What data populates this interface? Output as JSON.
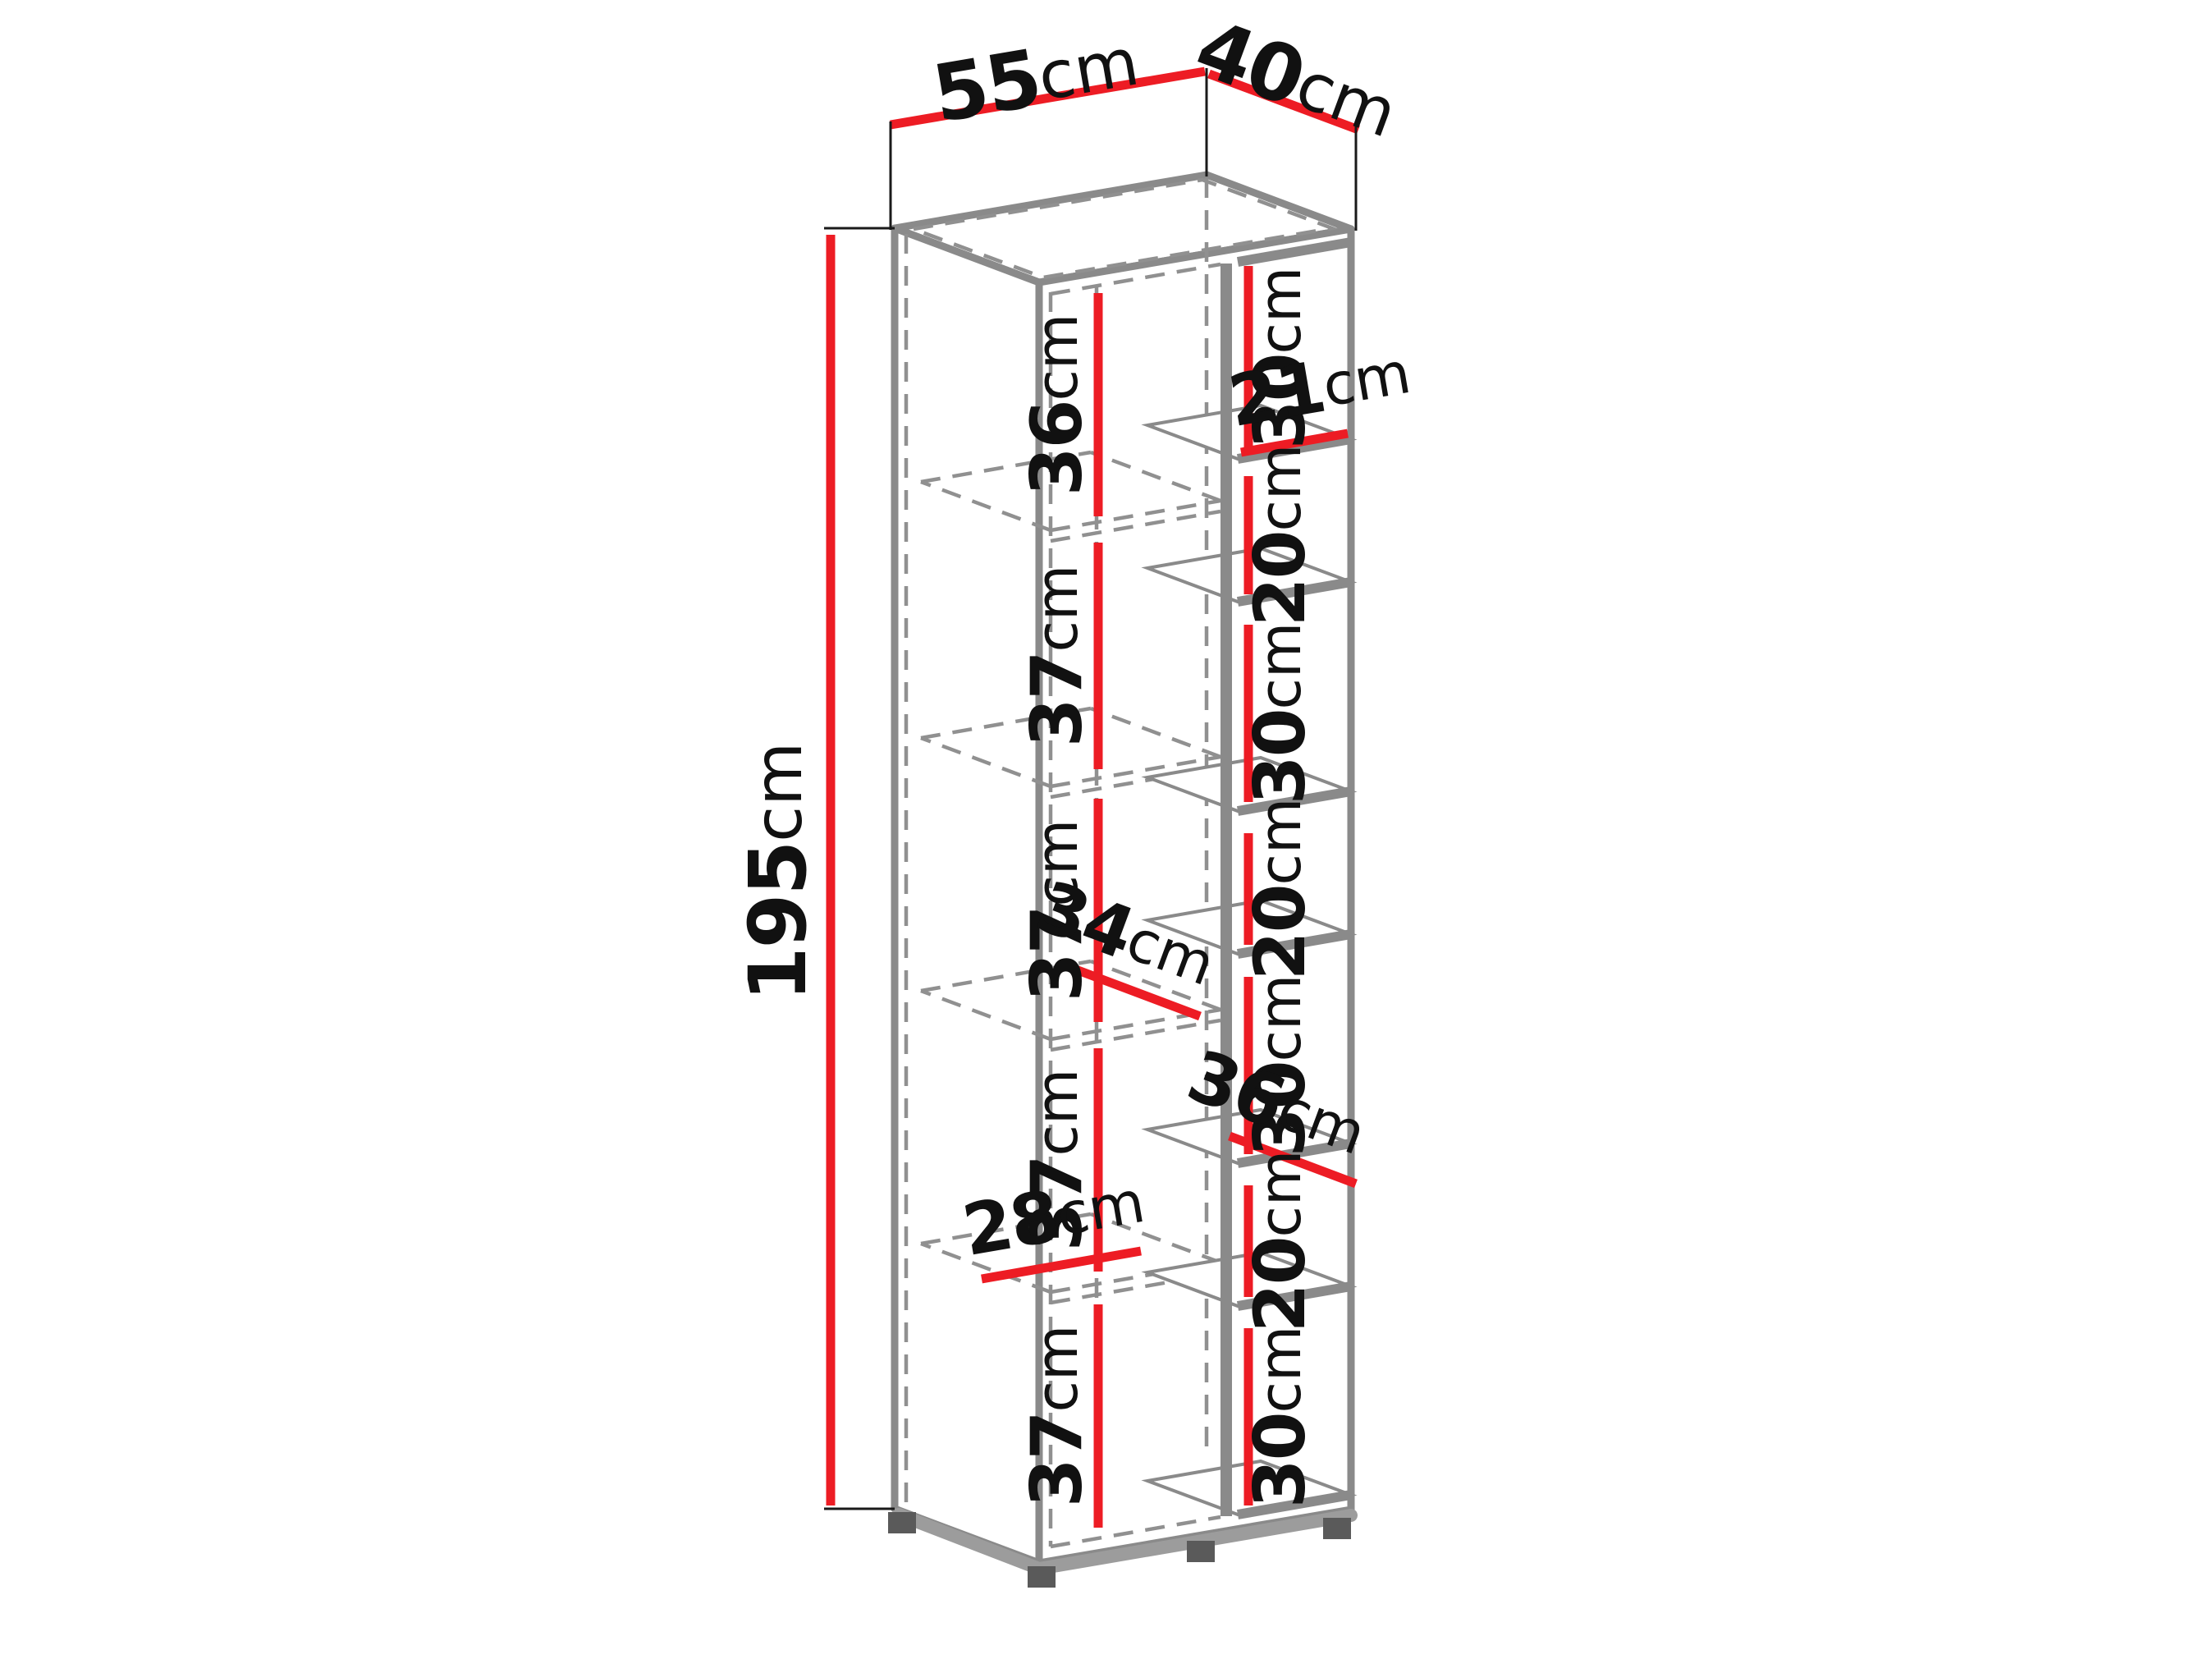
{
  "drawing": {
    "background": "#ffffff",
    "colors": {
      "edge_gray": "#8a8a8a",
      "hidden_line_gray": "#909090",
      "dimension_red": "#ed1c24",
      "extension_black": "#1a1a1a",
      "label_black": "#111111"
    },
    "overall_dimensions": {
      "width": {
        "value": "55",
        "unit": "cm"
      },
      "depth": {
        "value": "40",
        "unit": "cm"
      },
      "height": {
        "value": "195",
        "unit": "cm"
      }
    },
    "wardrobe_section": {
      "compartments": [
        {
          "value": "36",
          "unit": "cm"
        },
        {
          "value": "37",
          "unit": "cm"
        },
        {
          "value": "37",
          "unit": "cm"
        },
        {
          "value": "37",
          "unit": "cm"
        },
        {
          "value": "37",
          "unit": "cm"
        }
      ],
      "shelf_depth": {
        "value": "34",
        "unit": "cm"
      },
      "shelf_width": {
        "value": "28",
        "unit": "cm"
      }
    },
    "open_shelf_column": {
      "compartments": [
        {
          "value": "30",
          "unit": "cm"
        },
        {
          "value": "20",
          "unit": "cm"
        },
        {
          "value": "30",
          "unit": "cm"
        },
        {
          "value": "20",
          "unit": "cm"
        },
        {
          "value": "30",
          "unit": "cm"
        },
        {
          "value": "20",
          "unit": "cm"
        },
        {
          "value": "30",
          "unit": "cm"
        }
      ],
      "niche_width": {
        "value": "21",
        "unit": "cm"
      },
      "niche_depth": {
        "value": "36",
        "unit": "cm"
      }
    }
  }
}
